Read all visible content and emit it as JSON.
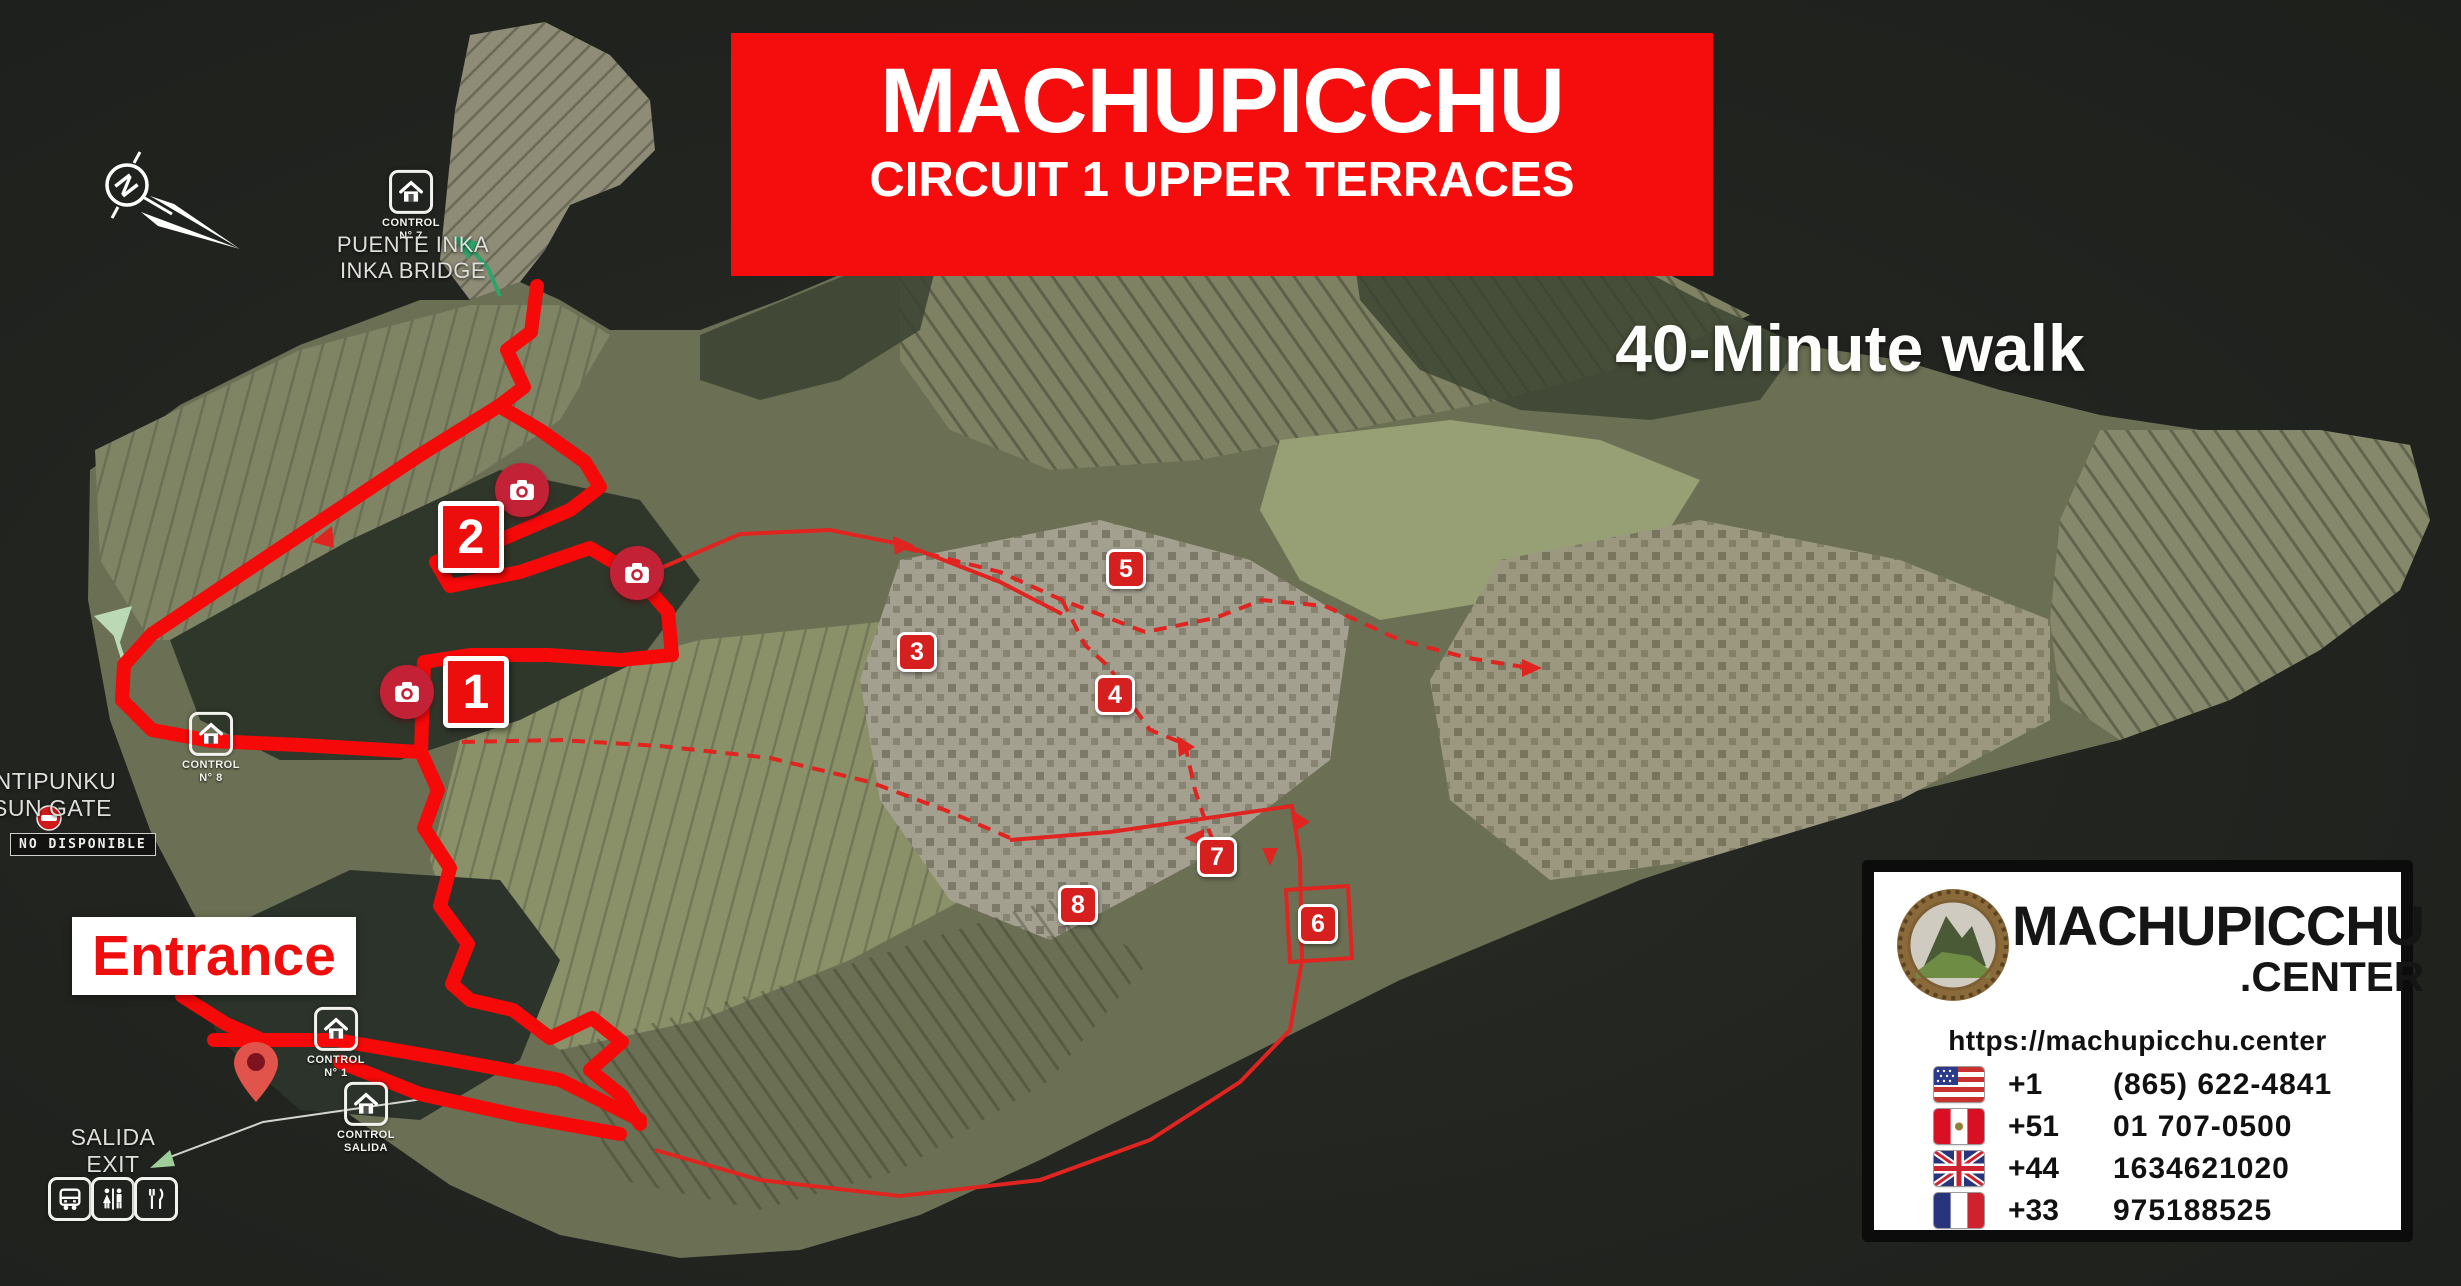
{
  "banner": {
    "title": "MACHUPICCHU",
    "subtitle": "CIRCUIT 1 UPPER TERRACES"
  },
  "duration": "40-Minute walk",
  "compass": {
    "letter": "N"
  },
  "poi": {
    "puente_inka": {
      "control_label": "CONTROL",
      "control_number": "N° 7",
      "name_line1": "PUENTE INKA",
      "name_line2": "INKA BRIDGE"
    },
    "intipunku": {
      "name_line1": "INTIPUNKU",
      "name_line2": "SUN GATE",
      "status": "NO DISPONIBLE"
    },
    "entrance": {
      "label": "Entrance"
    },
    "exit": {
      "name_line1": "SALIDA",
      "name_line2": "EXIT"
    },
    "control_8": {
      "control_label": "CONTROL",
      "control_number": "N° 8"
    },
    "control_1": {
      "control_label": "CONTROL",
      "control_number": "N° 1"
    },
    "control_salida": {
      "control_label": "CONTROL",
      "control_number": "SALIDA"
    }
  },
  "markers": {
    "photo_stop_1": "1",
    "photo_stop_2": "2",
    "waypoints": [
      "3",
      "4",
      "5",
      "6",
      "7",
      "8"
    ]
  },
  "icons": {
    "compass": "compass-north-arrow",
    "control": "control-house",
    "camera": "photo-spot-camera",
    "entrance_pin": "location-pin",
    "no_entry": "no-entry-sign",
    "bus": "bus",
    "restrooms": "restrooms",
    "restaurant": "restaurant",
    "exit_arrow": "exit-direction-arrow"
  },
  "info_box": {
    "brand_line1": "MACHUPICCHU",
    "brand_line2": ".CENTER",
    "url": "https://machupicchu.center",
    "phones": [
      {
        "flag": "united-states",
        "code": "+1",
        "number": "(865) 622-4841"
      },
      {
        "flag": "peru",
        "code": "+51",
        "number": "01 707-0500"
      },
      {
        "flag": "united-kingdom",
        "code": "+44",
        "number": "1634621020"
      },
      {
        "flag": "france",
        "code": "+33",
        "number": "975188525"
      }
    ]
  },
  "colors": {
    "banner_red": "#f50d0d",
    "route_red": "#f50909",
    "marker_red": "#d61f1f",
    "camera_badge_red": "#c22136",
    "map_background": "#222420",
    "info_border": "#0c0c0c"
  }
}
